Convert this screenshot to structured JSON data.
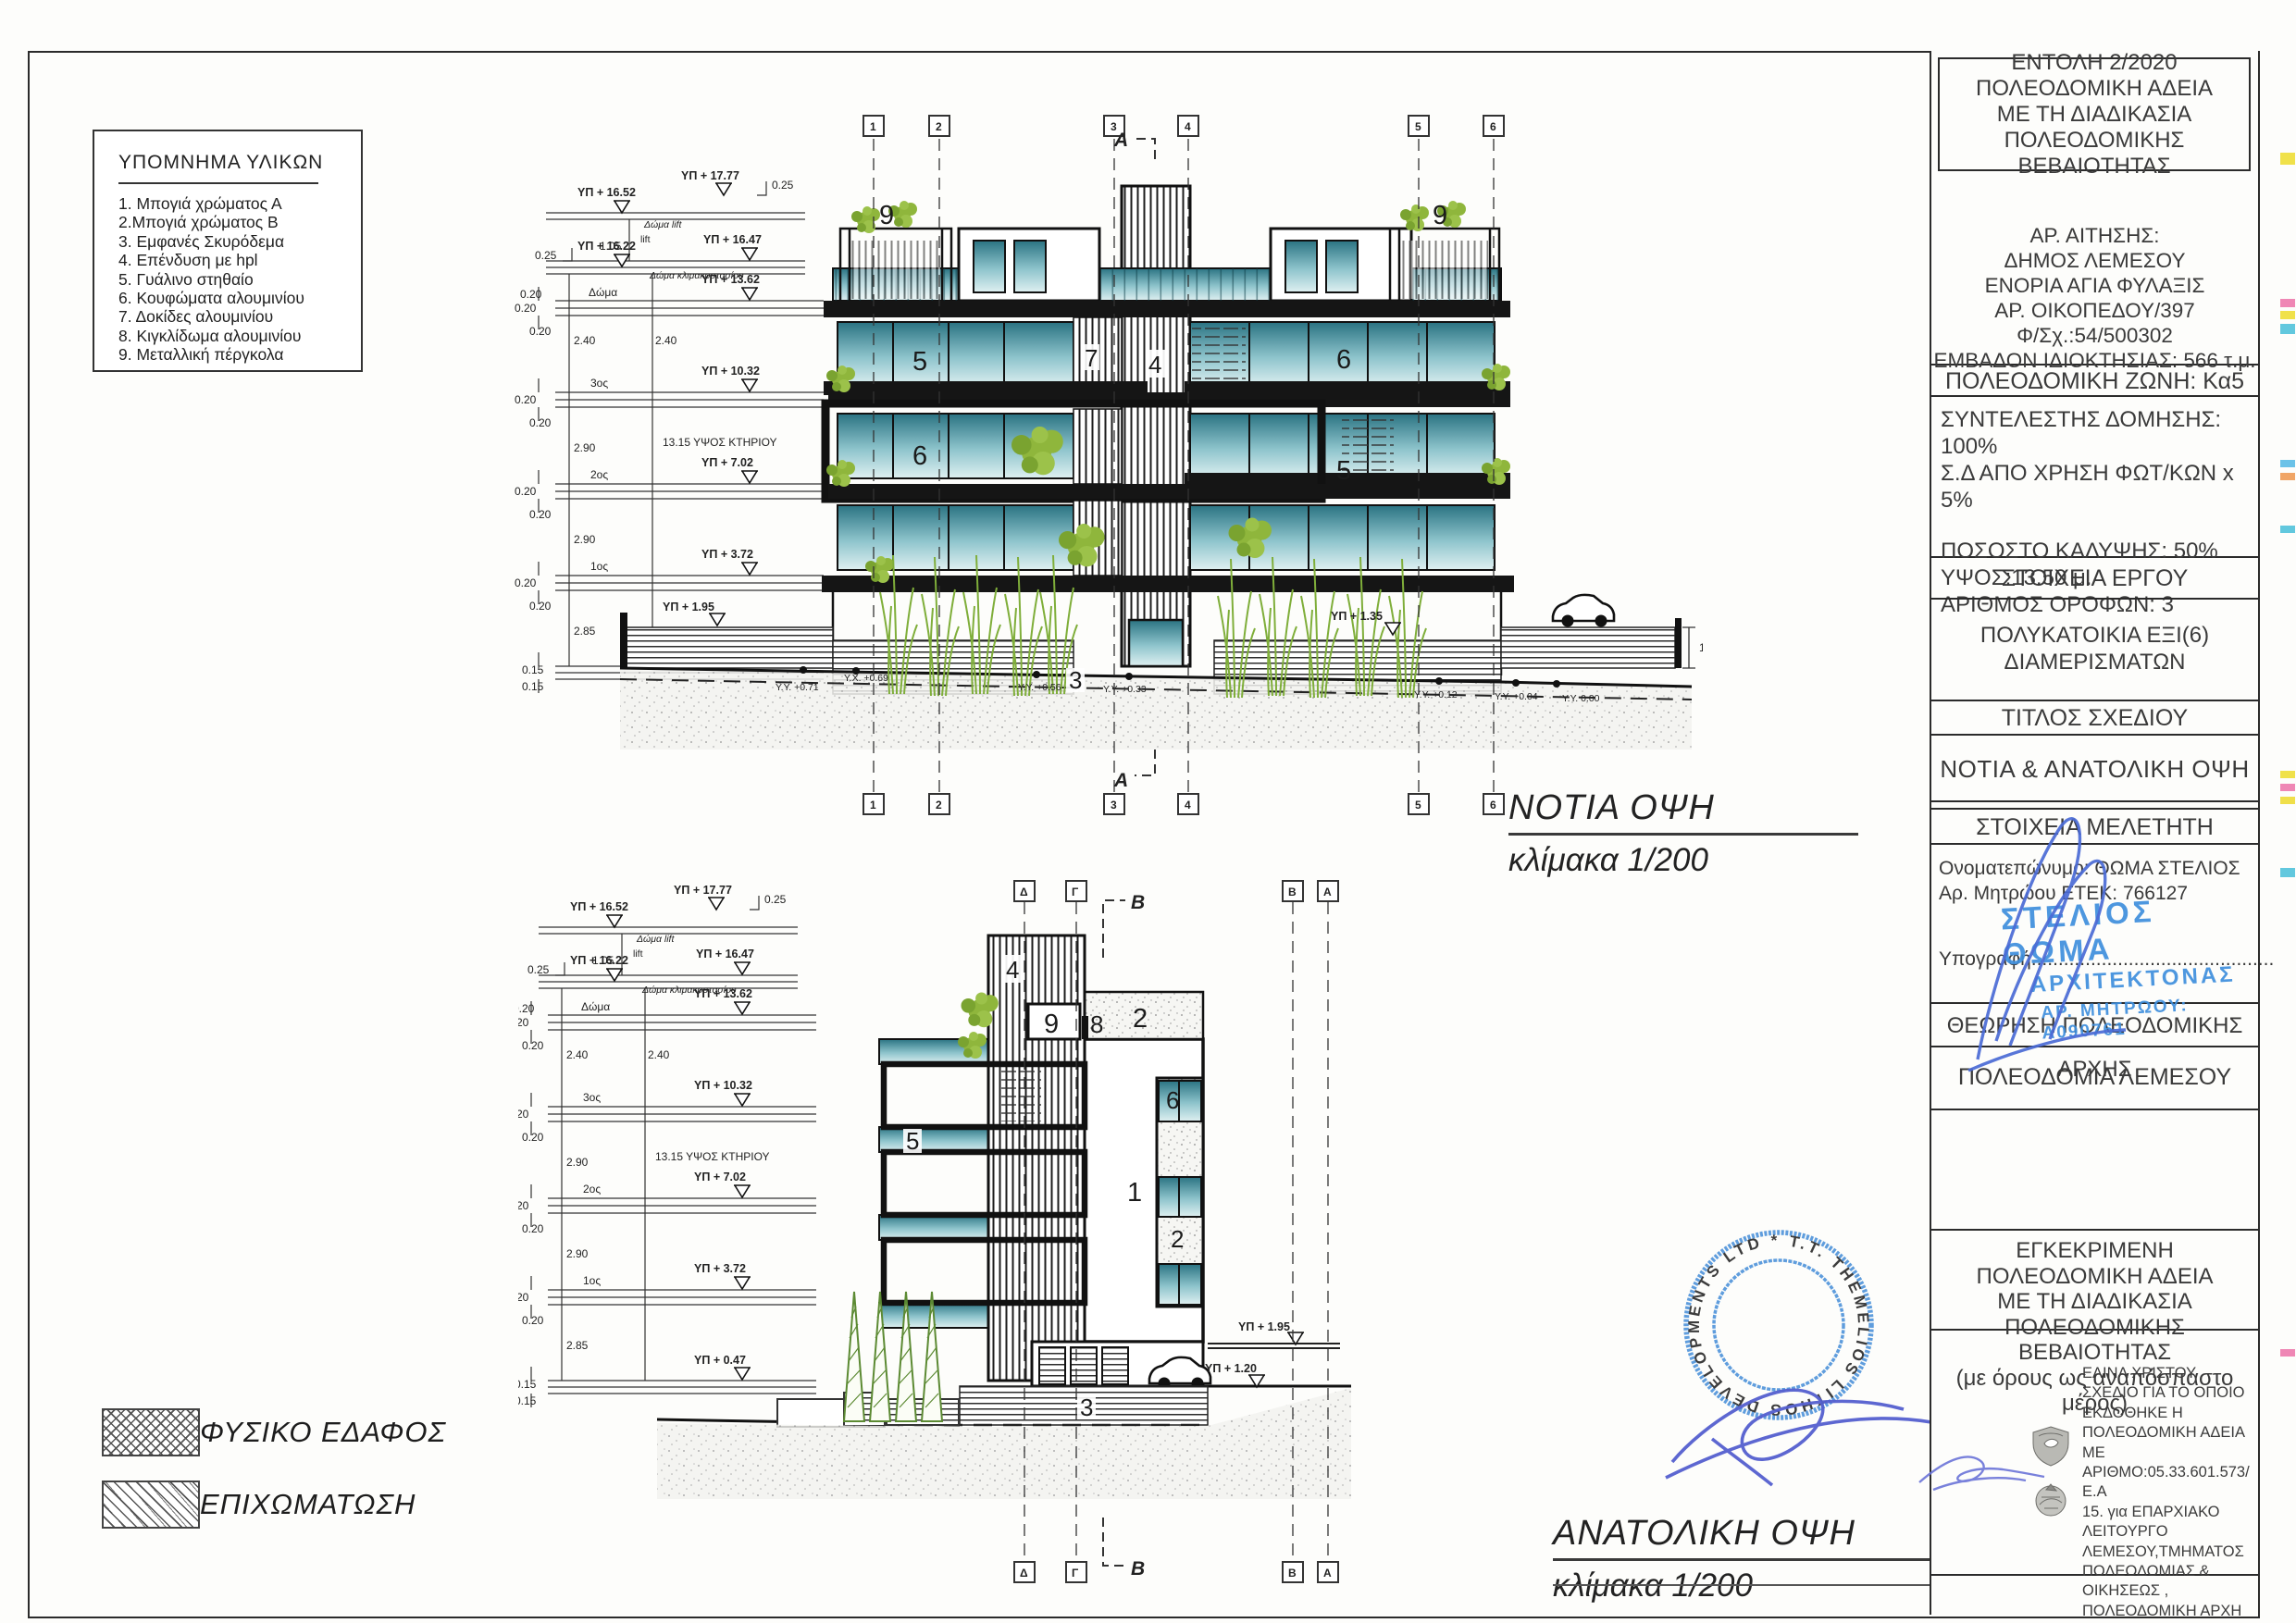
{
  "colors": {
    "glass_teal": "#4f98a8",
    "plant_green": "#7fae3a",
    "stamp_blue": "#4a90d9",
    "pen_blue": "#5560cf"
  },
  "legend": {
    "title": "ΥΠΟΜΝΗΜΑ ΥΛΙΚΩΝ",
    "items": [
      "1. Μπογιά χρώματος  Α",
      "2.Μπογιά χρώματος  Β",
      "3. Εμφανές Σκυρόδεμα",
      "4. Επένδυση με hpl",
      "5. Γυάλινο στηθαίο",
      "6. Κουφώματα αλουμινίου",
      "7. Δοκίδες αλουμινίου",
      "8. Κιγκλίδωμα αλουμινίου",
      "9. Μεταλλική πέργκολα"
    ]
  },
  "terrain_legend": {
    "natural": "ΦΥΣΙΚΟ ΕΔΑΦΟΣ",
    "fill": "ΕΠΙΧΩΜΑΤΩΣΗ"
  },
  "south": {
    "title": "ΝΟΤΙΑ ΟΨΗ",
    "scale": "κλίμακα  1/200",
    "grid": [
      "1",
      "2",
      "3",
      "4",
      "5",
      "6"
    ],
    "section": "A",
    "labels": {
      "pergola_l": "9",
      "pergola_r": "9",
      "f3_left": "5",
      "f3_louver": "7",
      "tower": "4",
      "f3_right": "6",
      "f2_left": "6",
      "f2_right": "5",
      "base": "3"
    }
  },
  "east": {
    "title": "ΑΝΑΤΟΛΙΚΗ ΟΨΗ",
    "scale": "κλίμακα  1/200",
    "grid": [
      "Δ",
      "Γ",
      "Β",
      "Α"
    ],
    "section": "B",
    "labels": {
      "tower": "4",
      "door": "9",
      "rail": "8",
      "parapet": "2",
      "balcony": "5",
      "window": "6",
      "wall": "1",
      "window2": "2",
      "base": "3"
    }
  },
  "levels": [
    {
      "elev": "ΥΠ + 17.77",
      "name": ""
    },
    {
      "elev": "ΥΠ + 16.52",
      "name": "Δώμα lift"
    },
    {
      "elev": "ΥΠ + 16.47",
      "name": ""
    },
    {
      "elev": "ΥΠ + 16.22",
      "name": "Δώμα κλιμακοστασίου"
    },
    {
      "elev": "ΥΠ + 13.62",
      "name": "Δώμα"
    },
    {
      "elev": "ΥΠ + 10.32",
      "name": "3ος"
    },
    {
      "elev": "ΥΠ + 7.02",
      "name": "2ος"
    },
    {
      "elev": "ΥΠ + 3.72",
      "name": "1ος"
    },
    {
      "elev": "ΥΠ + 0.47",
      "name": ""
    }
  ],
  "dims": {
    "d025": "0.25",
    "d105": "1.05",
    "lift": "lift",
    "d020": "0.20",
    "d240": "2.40",
    "d290": "2.90",
    "d285": "2.85",
    "d015": "0.15",
    "height": "13.15 ΥΨΟΣ ΚΤΗΡΙΟΥ",
    "wall": "1.20"
  },
  "marks": {
    "m195": "ΥΠ + 1.95",
    "m135": "ΥΠ + 1.35",
    "m120": "ΥΠ + 1.20",
    "y071": "Υ.Υ. +0.71",
    "x069": "Υ.Χ. +0.69",
    "y056": "Υ.Υ. +0.56",
    "y033": "Υ.Υ. +0.33",
    "y012": "Υ.Υ. +0.12",
    "y004": "Υ.Υ. +0.04",
    "y000": "Υ.Υ. 0.00"
  },
  "title_block": {
    "permit_lines": [
      "ΕΝΤΟΛΗ 2/2020",
      "ΠΟΛΕΟΔΟΜΙΚΗ ΑΔΕΙΑ",
      "ΜΕ ΤΗ ΔΙΑΔΙΚΑΣΙΑ ΠΟΛΕΟΔΟΜΙΚΗΣ",
      "ΒΕΒΑΙΟΤΗΤΑΣ"
    ],
    "application_lines": [
      "ΑΡ. ΑΙΤΗΣΗΣ:",
      "ΔΗΜΟΣ ΛΕΜΕΣΟΥ",
      "ΕΝΟΡΙΑ ΑΓΙΑ ΦΥΛΑΞΙΣ",
      "ΑΡ. ΟΙΚΟΠΕΔΟΥ/397",
      "Φ/Σχ.:54/500302",
      "ΕΜΒΑΔΟΝ ΙΔΙΟΚΤΗΣΙΑΣ: 566 τ.μ."
    ],
    "zone": "ΠΟΛΕΟΔΟΜΙΚΗ ΖΩΝΗ: Κα5",
    "coeff_lines": [
      "ΣΥΝΤΕΛΕΣΤΗΣ ΔΟΜΗΣΗΣ: 100%",
      "Σ.Δ ΑΠΟ ΧΡΗΣΗ ΦΩΤ/ΚΩΝ  x 5%",
      "ΠΟΣΟΣΤΟ ΚΑΛΥΨΗΣ: 50%",
      "ΥΨΟΣ:13.50 μ.",
      "ΑΡΙΘΜΟΣ ΟΡΟΦΩΝ: 3"
    ],
    "project_header": "ΣΤΟΙΧΕΙΑ ΕΡΓΟΥ",
    "project_lines": [
      "ΠΟΛΥΚΑΤΟΙΚΙΑ ΕΞΙ(6)",
      "ΔΙΑΜΕΡΙΣΜΑΤΩΝ"
    ],
    "drawing_title_header": "ΤΙΤΛΟΣ ΣΧΕΔΙΟΥ",
    "drawing_title": "ΝΟΤΙΑ & ΑΝΑΤΟΛΙΚΗ ΟΨΗ",
    "designer_header": "ΣΤΟΙΧΕΙΑ ΜΕΛΕΤΗΤΗ",
    "designer_name": "Ονοματεπώνυμο: ΘΩΜΑ ΣΤΕΛΙΟΣ",
    "designer_reg": "Αρ. Μητρώου ΕΤΕΚ: 766127",
    "signature_label": "Υπογραφή.............................................",
    "designer_stamp": [
      "ΣΤΕΛΙΟΣ ΘΩΜΑ",
      "ΑΡΧΙΤΕΚΤΟΝΑΣ",
      "ΑΡ. ΜΗΤΡΩΟΥ: Α090761"
    ],
    "approval_header": "ΘΕΩΡΗΣΗ ΠΟΛΕΟΔΟΜΙΚΗΣ ΑΡΧΗΣ",
    "authority": "ΠΟΛΕΟΔΟΜΙΑ ΛΕΜΕΣΟΥ",
    "approved_lines": [
      "ΕΓΚΕΚΡΙΜΕΝΗ ΠΟΛΕΟΔΟΜΙΚΗ ΑΔΕΙΑ",
      "ΜΕ ΤΗ ΔΙΑΔΙΚΑΣΙΑ ΠΟΛΕΟΔΟΜΙΚΗΣ",
      "ΒΕΒΑΙΟΤΗΤΑΣ",
      "(με όρους ως αναπόσπαστο μέρος)"
    ],
    "digital_signature_lines": [
      "ΕΛΙΝΑ ΧΡΙΣΤΟΥ",
      "ΣΧΕΔΙΟ ΓΙΑ ΤΟ ΟΠΟΙΟ",
      "ΕΚΔΟΘΗΚΕ Η",
      "ΠΟΛΕΟΔΟΜΙΚΗ ΑΔΕΙΑ ΜΕ",
      "ΑΡΙΘΜΟ:05.33.601.573/Ε.Α",
      "15. για ΕΠΑΡΧΙΑΚΟ",
      "ΛΕΙΤΟΥΡΓΟ",
      "ΛΕΜΕΣΟΥ,ΤΜΗΜΑΤΟΣ",
      "ΠΟΛΕΟΔΟΜΙΑΣ &",
      "ΟΙΚΗΣΕΩΣ ,",
      "ΠΟΛΕΟΔΟΜΙΚΗ ΑΡΧΗ",
      "2023.01.16 14:36:23 +02'00'"
    ]
  },
  "contractor_stamp": {
    "ring": "T.T. THEMELIOS LITHOS DEVELOPMENTS LTD *"
  }
}
